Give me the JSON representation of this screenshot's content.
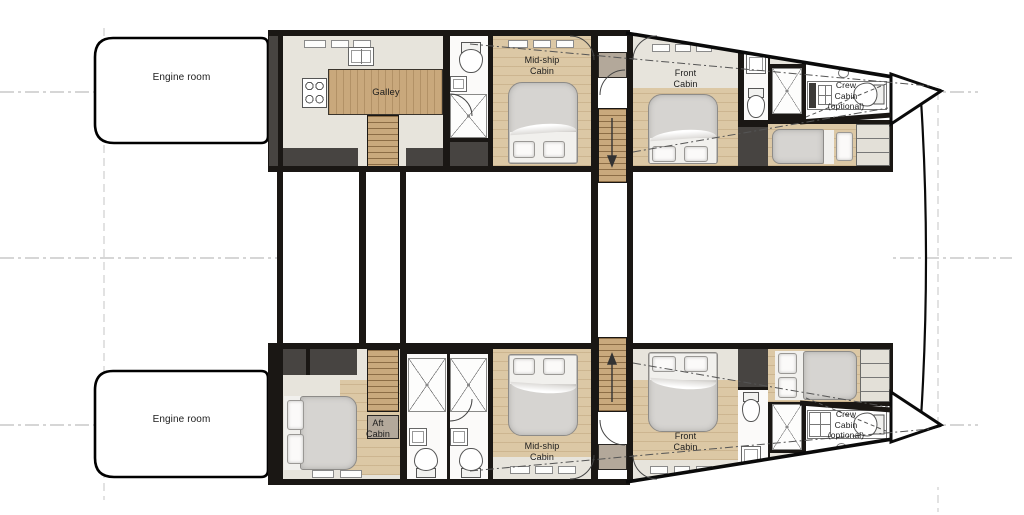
{
  "plan": {
    "labels": {
      "engine_room_top": "Engine room",
      "engine_room_bottom": "Engine room",
      "galley": "Galley",
      "midship_cabin_top": "Mid-ship\nCabin",
      "front_cabin_top": "Front\nCabin",
      "crew_cabin_top": "Crew\nCabin\n(optional)",
      "aft_cabin": "Aft\nCabin",
      "midship_cabin_bottom": "Mid-ship\nCabin",
      "front_cabin_bottom": "Front\nCabin",
      "crew_cabin_bottom": "Crew\nCabin\n(optional)"
    },
    "colors": {
      "wall": "#1a1714",
      "storage": "#474441",
      "floor_beige": "#e7e4dc",
      "floor_white": "#fbfaf9",
      "wood_floor": "#dcc8a5",
      "wood_stairs": "#c9a97d",
      "landing": "#b3a89a",
      "mattress": "#d6d4d1",
      "linen": "#f1f0ed",
      "cabinet": "#e3e0d8",
      "gridline": "#c0c0c0",
      "outline": "#000000"
    }
  }
}
